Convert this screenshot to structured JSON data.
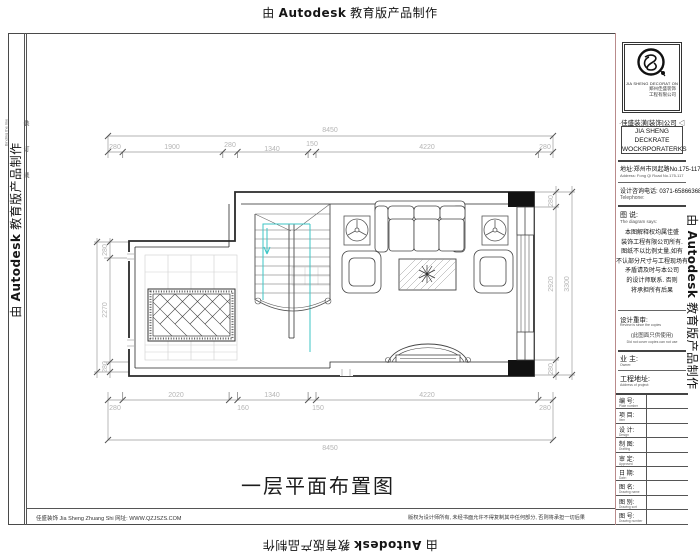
{
  "watermark": {
    "prefix": "由",
    "brand": "Autodesk",
    "suffix": "教育版产品制作"
  },
  "binding": {
    "label": "装订线",
    "label_en": "Binding the line"
  },
  "plan": {
    "title": "一层平面布置图",
    "dims": {
      "top_total": "8450",
      "top_segments": [
        "280",
        "1900",
        "280",
        "1340",
        "150",
        "4220",
        "280"
      ],
      "bottom_segments": [
        "280",
        "2020",
        "160",
        "1340",
        "150",
        "4220",
        "280"
      ],
      "bottom_total": "8450",
      "left_segments": [
        "280",
        "2270",
        "280"
      ],
      "right_segments": [
        "280",
        "2920",
        "280"
      ],
      "right_total": "3300"
    }
  },
  "titleblock": {
    "logo": {
      "caption_en": "JIA SHENG DECORAT ON",
      "caption_cn1": "郑州佳盛装饰",
      "caption_cn2": "工程有限公司"
    },
    "company_cn": "·佳盛装潢[装饰]公司 ◁",
    "company_en_line1": "JIA SHENG DECKRATE",
    "company_en_line2": "WOCKRPORATERKS",
    "address_cn": "地址:郑州市凤起路No.175-117",
    "address_en": "Address: Fong Qi Road No.175-117",
    "phone_cn": "设计咨询电话: 0371-65866368",
    "phone_en": "Telephone:",
    "note_title": "图 说:",
    "note_title_en": "The diagram says:",
    "note_lines": [
      "本图解释权均属佳盛",
      "装饰工程有限公司所有.",
      "图纸不以比例丈量,如有",
      "不认部分尺寸与工程现场有",
      "矛盾请及时与本公司",
      "的设计师联系. 否则",
      "将承担所有后果"
    ],
    "review_label": "设计重审:",
    "review_en": "Review is since the copies",
    "review_note": "(此图面只供使用)",
    "review_note_en": "Did not cover copies can not use",
    "owner_label": "业 主:",
    "owner_en": "Owner:",
    "site_label": "工程地址:",
    "site_en": "Address of project:",
    "rows": [
      {
        "label": "编 号:",
        "en": "Plate number"
      },
      {
        "label": "项 目:",
        "en": "Item"
      },
      {
        "label": "设 计:",
        "en": "Design"
      },
      {
        "label": "制 图:",
        "en": "Drafting"
      },
      {
        "label": "审 定:",
        "en": "Approved"
      },
      {
        "label": "日 期:",
        "en": "Date:"
      },
      {
        "label": "图 名:",
        "en": "Drawing name"
      },
      {
        "label": "图 别:",
        "en": "Drawing sort"
      },
      {
        "label": "图 号:",
        "en": "Drawing number"
      }
    ]
  },
  "footer": {
    "left": "佳盛装饰 Jia Sheng Zhuang Shi    网址: WWW.QZJSZS.COM",
    "right": "版权为设计师所有, 未经书面允许不得复制其中任何部分, 否则将承担一切后果"
  }
}
